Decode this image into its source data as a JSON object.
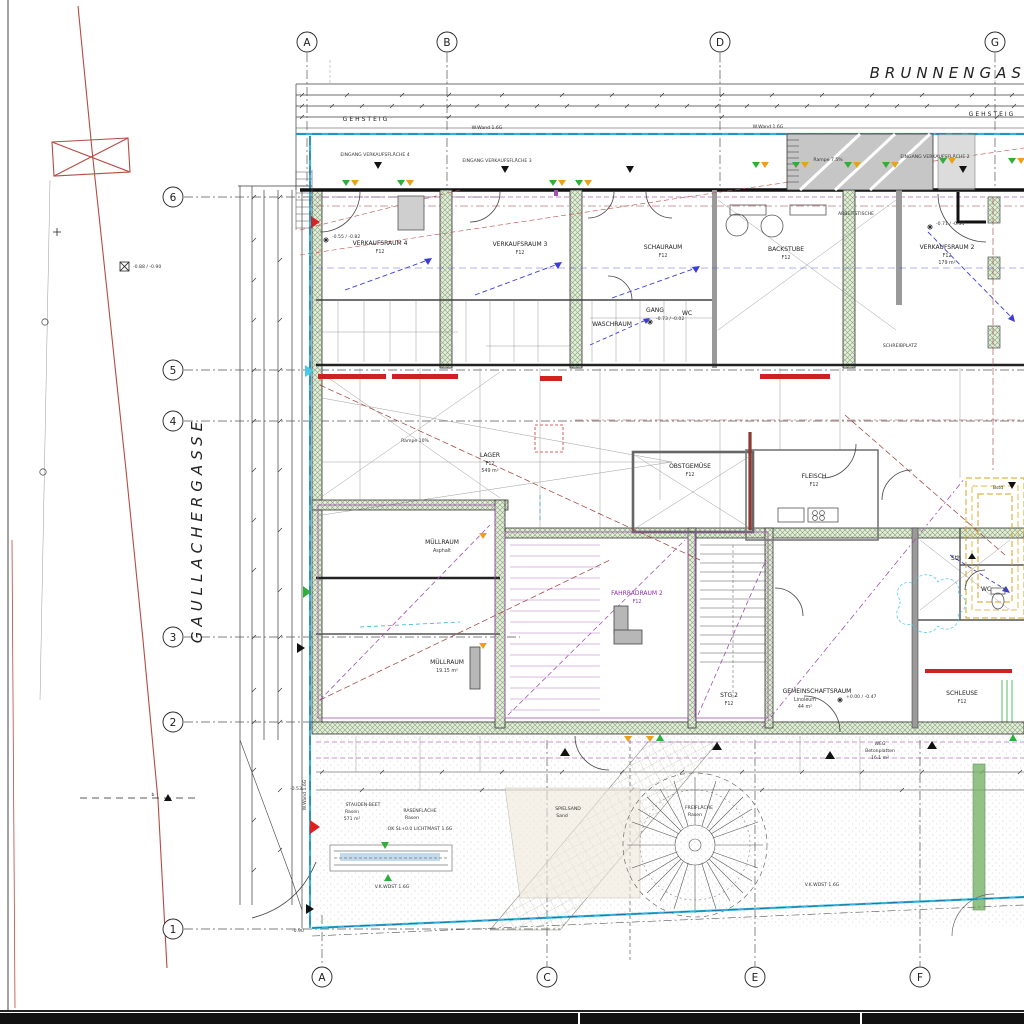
{
  "streets": {
    "top": "BRUNNENGASSE",
    "left": "GAULLACHERGASSE",
    "sidewalk_top_left": "GEHSTEIG",
    "sidewalk_top_right": "GEHSTEIG"
  },
  "grid": {
    "top": [
      "A",
      "B",
      "D",
      "G"
    ],
    "left": [
      "6",
      "5",
      "4",
      "3",
      "2",
      "1"
    ],
    "bottom": [
      "A",
      "C",
      "E",
      "F"
    ]
  },
  "rooms": [
    {
      "name": "VERKAUFSRAUM 4",
      "sub": "F12"
    },
    {
      "name": "VERKAUFSRAUM 3",
      "sub": "F12"
    },
    {
      "name": "SCHAURAUM",
      "sub": "F12"
    },
    {
      "name": "BACKSTUBE",
      "sub": "F12"
    },
    {
      "name": "VERKAUFSRAUM 2",
      "sub": "F12",
      "area": "179 m²"
    },
    {
      "name": "WASCHRAUM",
      "sub": "F12"
    },
    {
      "name": "GANG",
      "sub": "F12"
    },
    {
      "name": "WC",
      "sub": "F12"
    },
    {
      "name": "LAGER",
      "sub": "F12",
      "area": "549 m²"
    },
    {
      "name": "OBSTGEMÜSE",
      "sub": "F12"
    },
    {
      "name": "FLEISCH",
      "sub": "F12"
    },
    {
      "name": "MÜLLRAUM",
      "sub": "Asphalt"
    },
    {
      "name": "MÜLLRAUM",
      "sub": "19.15 m²"
    },
    {
      "name": "FAHRRADRAUM 2",
      "sub": "F12"
    },
    {
      "name": "GEMEINSCHAFTSRAUM",
      "sub": "Linoleum",
      "area": "44 m²"
    },
    {
      "name": "STG 2",
      "sub": "F12"
    },
    {
      "name": "SCHLEUSE",
      "sub": "F12"
    },
    {
      "name": "WC"
    },
    {
      "name": "Sth"
    },
    {
      "name": "SCHREIBPLATZ"
    },
    {
      "name": "ARBEITSTISCHE"
    }
  ],
  "ramps": [
    "Rampe 7.5%",
    "Rampe 10%"
  ],
  "entrances": [
    "EINGANG VERKAUFSFLÄCHE 4",
    "EINGANG VERKAUFSFLÄCHE 3",
    "EINGANG VERKAUFSFLÄCHE 2"
  ],
  "wall_notes": [
    "W.Wand 1.6G",
    "W.Wand 1.6G",
    "W.Wand 1.6G"
  ],
  "site_notes": [
    "V.K.WDST 1.6G",
    "V.K.WDST 1.6G",
    "OK SL+0.0 LICHTMAST 1.6G",
    "Bstd",
    "b"
  ],
  "outdoor": [
    {
      "name": "STAUDEN-BEET",
      "sub": "Rasen",
      "area": "571 m²"
    },
    {
      "name": "RASENFLÄCHE",
      "sub": "Rasen"
    },
    {
      "name": "SPIELSAND",
      "sub": "Sand"
    },
    {
      "name": "FREIFLÄCHE",
      "sub": "Rasen"
    },
    {
      "name": "WEG",
      "sub": "Betonplatten",
      "area": "16.1 m²"
    }
  ],
  "levels": [
    "-0.55 / -0.82",
    "-0.73 / -0.02",
    "-0.71 / -0.34",
    "+0.00 / -0.47",
    "-0.88 / -0.90",
    "-0.53",
    "-0.90"
  ],
  "colors": {
    "wall_hatch_green": "#e2edda",
    "accent_red": "#cc2222",
    "water_cyan": "#35b2e0",
    "marking_purple": "#a050b0",
    "slope_blue": "#3c3cd8",
    "marker_green": "#2fae3a",
    "marker_orange": "#e8a11c",
    "shaft_yellow": "#d9a21b",
    "boundary_red": "#b54a42"
  }
}
